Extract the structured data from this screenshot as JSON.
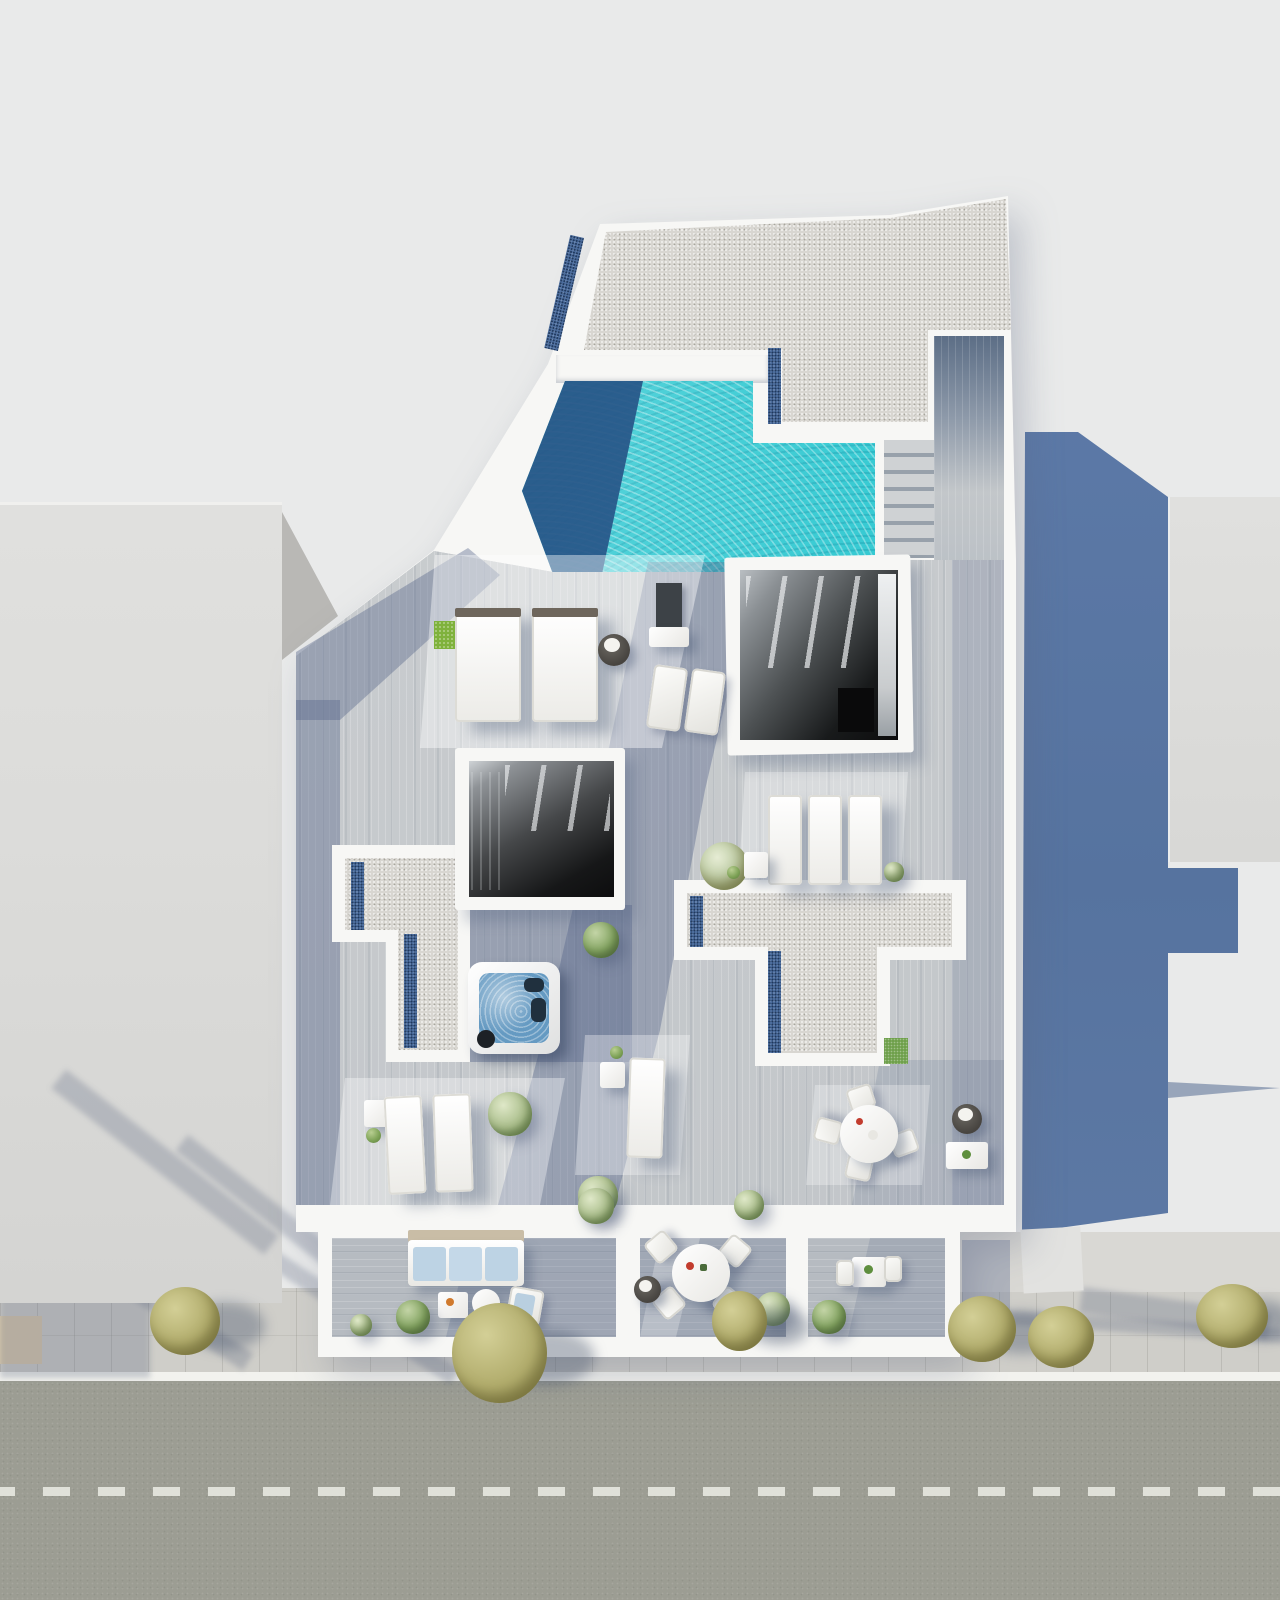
{
  "scene": {
    "title": "Aerial 3D architectural render of a rooftop terrace floor plan with pool, street below",
    "labels": {
      "left_building": "Neighbouring building roof (left)",
      "right_building": "Neighbouring building roof (right)",
      "building_shadow": "Cast shadow of main building",
      "main_building": "Main building rooftop level",
      "gravel_roof": "Gravel flat roof",
      "pool": "Turquoise swimming pool",
      "pool_deep": "Pool deep/shaded zone",
      "walkway": "Side deck walkway",
      "stairs": "Outdoor stairs to pool deck",
      "stairwell_1": "Open stairwell atrium (east)",
      "stairwell_2": "Open stairwell atrium (west)",
      "gravel_terrace_left": "Gravel roof section (left, L-shape)",
      "gravel_terrace_right": "Gravel roof section (centre, T-shape)",
      "jacuzzi": "Jacuzzi hot tub",
      "daybeds": "Two white day beds",
      "sun_loungers": "Sun loungers",
      "dining_set_round": "Round dining table with four chairs",
      "balconies": "Lower balconies with outdoor furniture",
      "sofa": "Outdoor sofa with blue cushions",
      "street": "Street with dashed centre line",
      "sidewalk": "Sidewalk with street trees",
      "trees": "Olive-green street trees",
      "grass_patch": "Artificial grass patch",
      "shower_panel": "Outdoor shower panel"
    },
    "palette": {
      "background": "#e9eaea",
      "neighbour_roof": "#dcdcda",
      "shadow_blue": "#5a76a4",
      "white_wall": "#f7f7f5",
      "gravel": "#d8d6d1",
      "blue_gravel": "#4e6f9f",
      "deck_wood": "#c6c9cc",
      "pool_turquoise": "#27c6cf",
      "pool_navy": "#2a5a8e",
      "jacuzzi_water": "#659ac2",
      "road": "#9c9d93",
      "sidewalk": "#cfcec9",
      "curb": "#f2f2ee",
      "tree_olive": "#b2ad6d",
      "grass": "#6fa04c",
      "cushion_blue": "#bdd3e4"
    },
    "counts": {
      "street_trees": 6,
      "day_beds": 2,
      "sun_loungers_mid_row": 3,
      "sun_loungers_lower": 4,
      "round_dining_tables": 2,
      "balconies": 3,
      "stairwell_openings": 2
    }
  }
}
